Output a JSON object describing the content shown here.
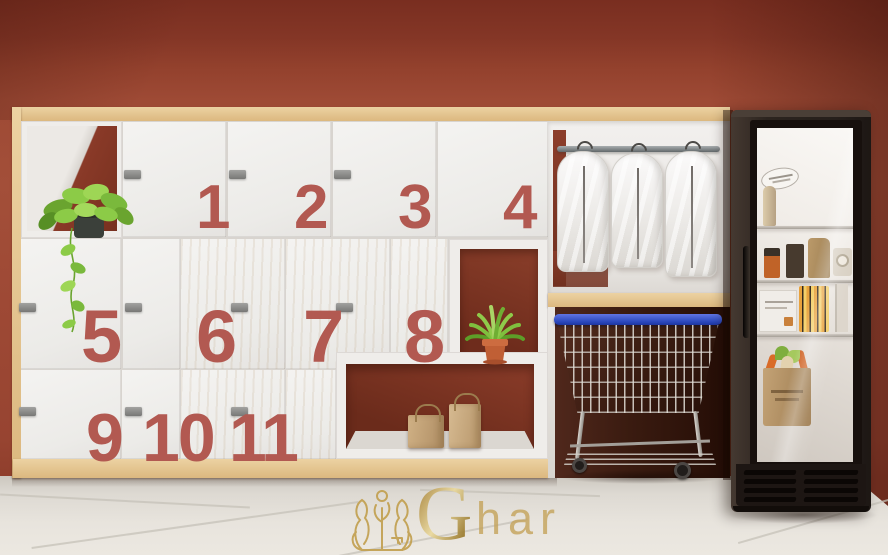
{
  "watermark": {
    "initial": "G",
    "rest": "har"
  },
  "lockers": {
    "numbers": [
      "1",
      "2",
      "3",
      "4",
      "5",
      "6",
      "7",
      "8",
      "9",
      "10",
      "11"
    ]
  },
  "palette": {
    "wall": "#9e4a35",
    "ceiling": "#7c3022",
    "right_wall": "#7e3424",
    "wood_trim": "#dfbd87",
    "wood_door": "#e9d0a3",
    "white_door": "#f0efed",
    "locker_number": "#b25951",
    "cubby_back": "#76301f",
    "floor": "#e4e0d9",
    "cart_rim_blue": "#2f52c8",
    "fridge_body": "#2a221e",
    "logo_gold": "#c2a050",
    "plant_green": "#7ab93c"
  }
}
